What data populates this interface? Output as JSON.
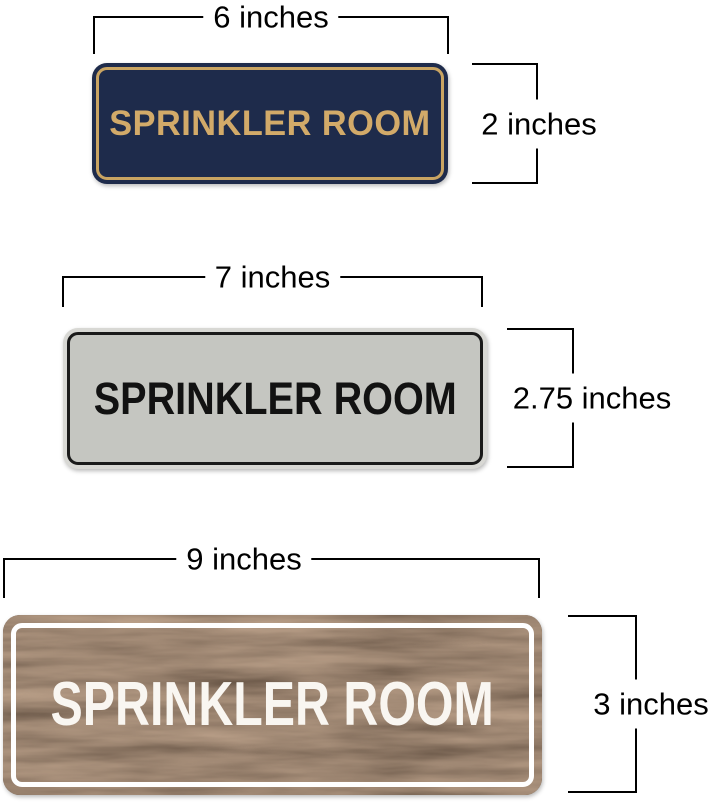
{
  "page": {
    "background_color": "#ffffff",
    "description": "Sprinkler Room sign size comparison diagram"
  },
  "dimension_style": {
    "line_color": "#000000",
    "label_color": "#000000"
  },
  "signs": [
    {
      "name": "navy-gold-sign",
      "text": "SPRINKLER ROOM",
      "width_label": "6 inches",
      "height_label": "2 inches",
      "colors": {
        "background": "#1e2b4b",
        "border": "#c9a462",
        "text": "#d2aa69"
      }
    },
    {
      "name": "silver-black-sign",
      "text": "SPRINKLER ROOM",
      "width_label": "7 inches",
      "height_label": "2.75 inches",
      "colors": {
        "rim": "#d8d8d4",
        "background": "#c5c6c1",
        "border": "#1a1a1a",
        "text": "#121212"
      }
    },
    {
      "name": "walnut-white-sign",
      "text": "SPRINKLER ROOM",
      "width_label": "9 inches",
      "height_label": "3 inches",
      "colors": {
        "background": "#4f3a28",
        "border": "#ffffff",
        "text": "#f9f6f1"
      }
    }
  ]
}
